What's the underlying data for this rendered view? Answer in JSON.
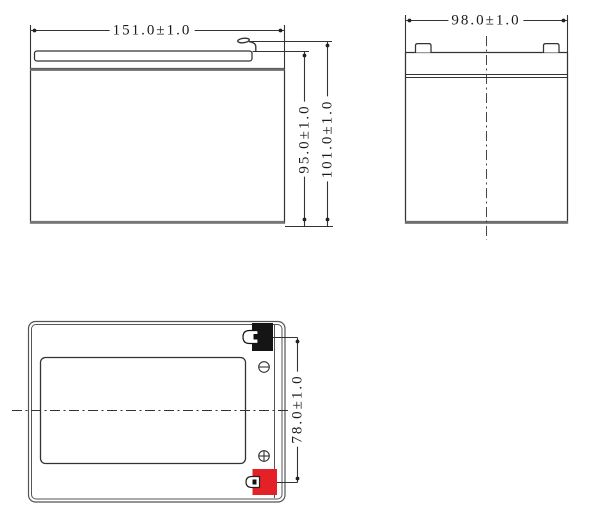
{
  "views": {
    "front": {
      "length": "151.0±1.0",
      "case_height": "95.0±1.0",
      "total_height": "101.0±1.0"
    },
    "side": {
      "width": "98.0±1.0"
    },
    "top": {
      "terminal_spacing": "78.0±1.0"
    }
  },
  "colors": {
    "line": "#333333",
    "thick_edge": "#6e6e6e",
    "negative_terminal": "#151515",
    "positive_terminal": "#e32127"
  },
  "icons": {
    "negative_terminal": "circle-minus-icon",
    "positive_terminal": "circle-plus-icon",
    "terminal_blade": "faston-tab-icon"
  }
}
